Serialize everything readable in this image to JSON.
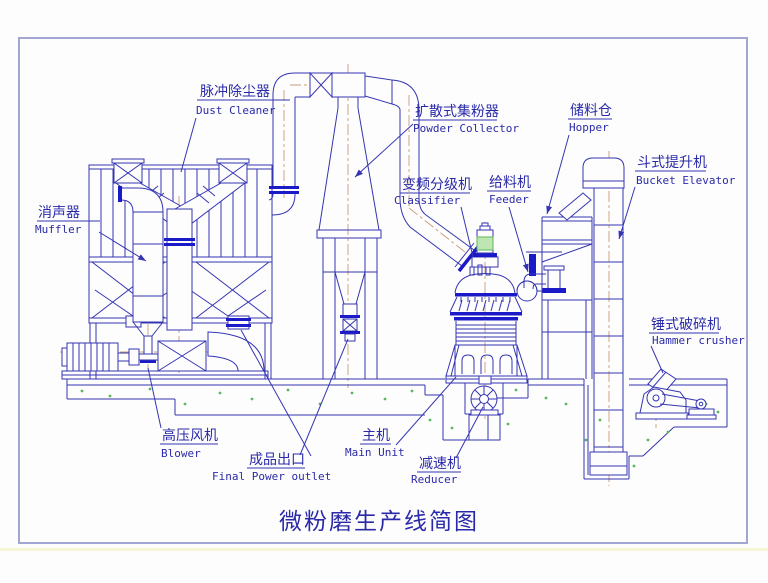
{
  "title": "微粉磨生产线简图",
  "labels": {
    "dust_cleaner": {
      "zh": "脉冲除尘器",
      "en": "Dust Cleaner"
    },
    "muffler": {
      "zh": "消声器",
      "en": "Muffler"
    },
    "powder_collector": {
      "zh": "扩散式集粉器",
      "en": "Powder Collector"
    },
    "classifier": {
      "zh": "变频分级机",
      "en": "Classifier"
    },
    "feeder": {
      "zh": "给料机",
      "en": "Feeder"
    },
    "hopper": {
      "zh": "储料仓",
      "en": "Hopper"
    },
    "bucket_elevator": {
      "zh": "斗式提升机",
      "en": "Bucket Elevator"
    },
    "hammer_crusher": {
      "zh": "锤式破碎机",
      "en": "Hammer crusher"
    },
    "blower": {
      "zh": "高压风机",
      "en": "Blower"
    },
    "final_outlet": {
      "zh": "成品出口",
      "en": "Final Power outlet"
    },
    "main_unit": {
      "zh": "主机",
      "en": "Main Unit"
    },
    "reducer": {
      "zh": "减速机",
      "en": "Reducer"
    }
  },
  "colors": {
    "line": "#3535b2",
    "accent": "#1a1ac8",
    "centerline": "#c89a78",
    "green": "#5cb85c",
    "green_fill": "#bfe6b2",
    "border": "#a2a6d2",
    "text": "#2a2aa8"
  }
}
